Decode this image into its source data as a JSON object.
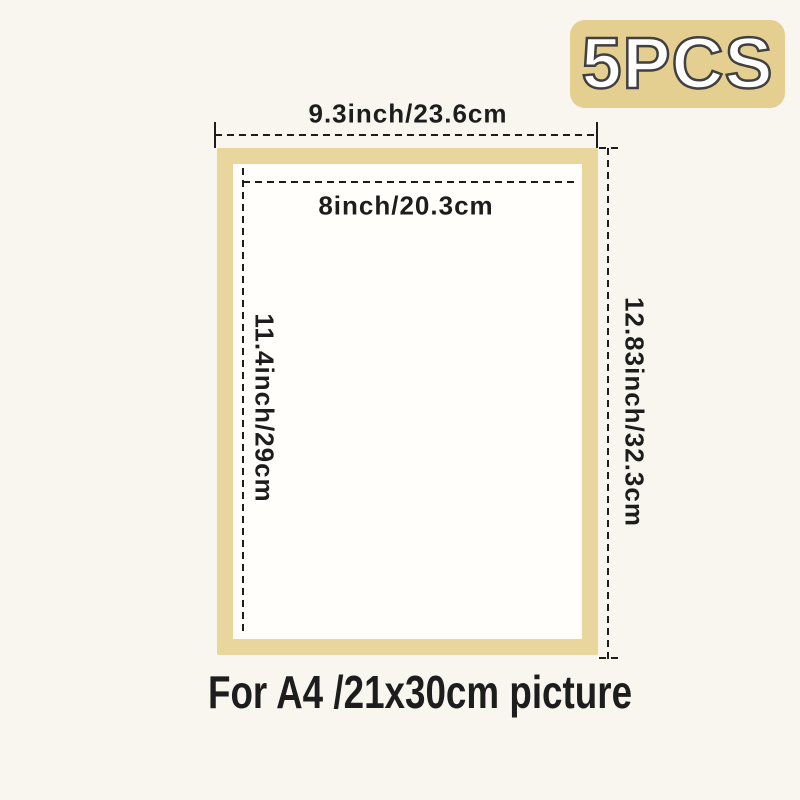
{
  "badge": {
    "label": "5PCS"
  },
  "dimensions": {
    "outer_width": "9.3inch/23.6cm",
    "inner_width": "8inch/20.3cm",
    "inner_height": "11.4inch/29cm",
    "outer_height": "12.83inch/32.3cm"
  },
  "caption": "For A4 /21x30cm picture",
  "colors": {
    "background": "#f8f6ef",
    "frame-border": "#e8d69c",
    "frame-inner": "#fffefa",
    "badge-bg": "#e5cf90",
    "badge-text": "#ffffff",
    "badge-outline": "#404040",
    "line": "#1d1d1d",
    "text": "#1d1d1d"
  }
}
